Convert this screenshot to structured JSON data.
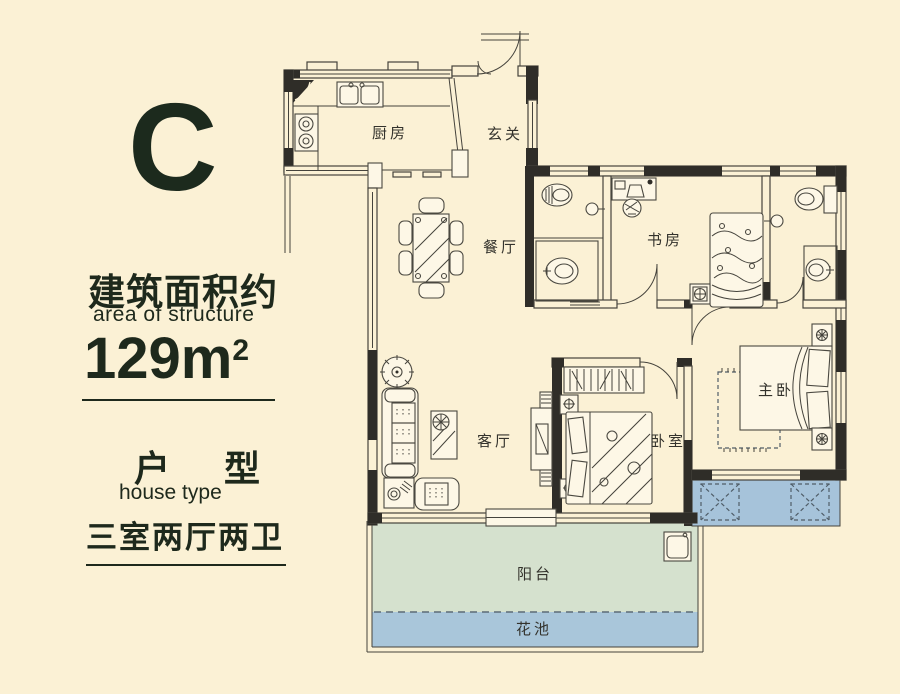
{
  "panel": {
    "unit_letter": "C",
    "area_title_zh": "建筑面积约",
    "area_title_en": "area of structure",
    "area_value": "129m",
    "area_exponent": "2",
    "type_title_zh": "户 型",
    "type_title_en": "house type",
    "layout_summary": "三室两厅两卫"
  },
  "rooms": {
    "kitchen": "厨房",
    "entry": "玄关",
    "dining": "餐厅",
    "study": "书房",
    "living": "客厅",
    "bedroom": "卧室",
    "master_bedroom": "主卧",
    "balcony": "阳台",
    "flower_bed": "花池"
  },
  "colors": {
    "background": "#fbf1d5",
    "wall": "#2f2d28",
    "text": "#1e291c",
    "balcony_fill": "#d5e1ce",
    "flower_bed_fill": "#a9c6da",
    "terrace_fill": "#a6c3da"
  }
}
